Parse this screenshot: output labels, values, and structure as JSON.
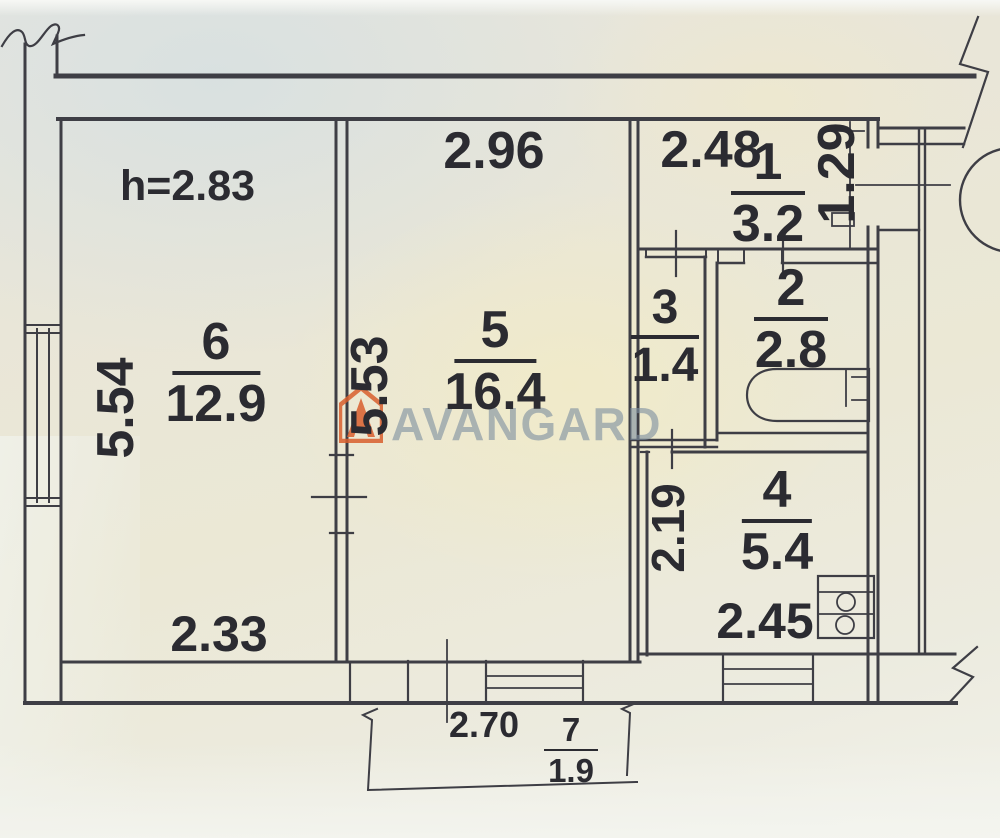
{
  "watermark": {
    "text": "AVANGARD",
    "logo": "house-logo",
    "logo_color": "#d95f2e",
    "text_color": "#7e909f"
  },
  "ceiling_height": "h=2.83",
  "ink_color": "#3e3e45",
  "paper_color": "#eae7d8",
  "rooms": [
    {
      "number": "6",
      "area": "12.9"
    },
    {
      "number": "5",
      "area": "16.4"
    },
    {
      "number": "1",
      "area": "3.2"
    },
    {
      "number": "2",
      "area": "2.8"
    },
    {
      "number": "3",
      "area": "1.4"
    },
    {
      "number": "4",
      "area": "5.4"
    },
    {
      "number": "7",
      "area": "1.9"
    }
  ],
  "dimensions": {
    "room6_depth": "5.54",
    "room6_width": "2.33",
    "room5_width": "2.96",
    "room5_depth": "5.53",
    "room5_window": "2.70",
    "hall_width": "2.48",
    "entry_depth": "1.29",
    "kitchen_depth": "2.19",
    "kitchen_width": "2.45"
  }
}
